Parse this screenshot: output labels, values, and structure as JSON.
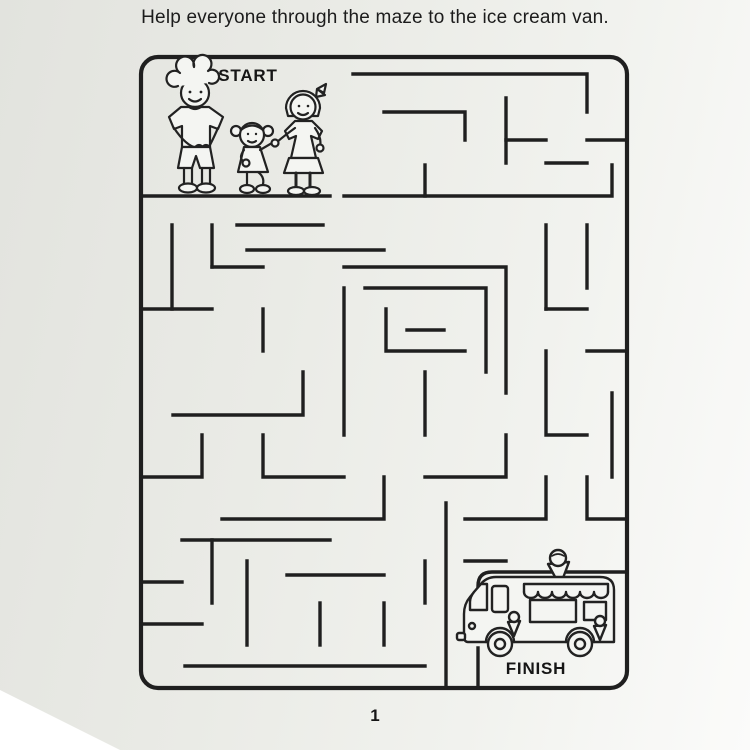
{
  "page": {
    "title": "Help everyone through the maze to the ice cream van.",
    "page_number": "1"
  },
  "colors": {
    "ink": "#1f1f1f",
    "paper_light": "#f1f2ee",
    "paper_dark": "#e2e3de"
  },
  "maze": {
    "start_label": "START",
    "finish_label": "FINISH",
    "finish_room_path": "M627,572 H492 Q478,572 478,586 V610 M478,648 V688",
    "walls": [
      [
        [
          141,
          196
        ],
        [
          330,
          196
        ]
      ],
      [
        [
          344,
          196
        ],
        [
          612,
          196
        ],
        [
          612,
          165
        ]
      ],
      [
        [
          425,
          196
        ],
        [
          425,
          165
        ]
      ],
      [
        [
          353,
          74
        ],
        [
          587,
          74
        ],
        [
          587,
          112
        ]
      ],
      [
        [
          384,
          112
        ],
        [
          465,
          112
        ],
        [
          465,
          140
        ]
      ],
      [
        [
          506,
          98
        ],
        [
          506,
          163
        ]
      ],
      [
        [
          506,
          140
        ],
        [
          546,
          140
        ]
      ],
      [
        [
          587,
          140
        ],
        [
          627,
          140
        ]
      ],
      [
        [
          546,
          163
        ],
        [
          587,
          163
        ]
      ],
      [
        [
          172,
          225
        ],
        [
          172,
          309
        ]
      ],
      [
        [
          212,
          225
        ],
        [
          212,
          267
        ]
      ],
      [
        [
          237,
          225
        ],
        [
          323,
          225
        ]
      ],
      [
        [
          212,
          267
        ],
        [
          263,
          267
        ]
      ],
      [
        [
          141,
          309
        ],
        [
          212,
          309
        ]
      ],
      [
        [
          247,
          250
        ],
        [
          384,
          250
        ]
      ],
      [
        [
          263,
          309
        ],
        [
          263,
          351
        ]
      ],
      [
        [
          344,
          267
        ],
        [
          506,
          267
        ],
        [
          506,
          393
        ]
      ],
      [
        [
          365,
          288
        ],
        [
          486,
          288
        ],
        [
          486,
          372
        ]
      ],
      [
        [
          386,
          309
        ],
        [
          386,
          351
        ],
        [
          465,
          351
        ]
      ],
      [
        [
          407,
          330
        ],
        [
          444,
          330
        ]
      ],
      [
        [
          344,
          288
        ],
        [
          344,
          435
        ]
      ],
      [
        [
          546,
          225
        ],
        [
          546,
          309
        ]
      ],
      [
        [
          587,
          225
        ],
        [
          587,
          288
        ]
      ],
      [
        [
          546,
          309
        ],
        [
          587,
          309
        ]
      ],
      [
        [
          587,
          351
        ],
        [
          627,
          351
        ]
      ],
      [
        [
          546,
          351
        ],
        [
          546,
          435
        ],
        [
          587,
          435
        ]
      ],
      [
        [
          173,
          415
        ],
        [
          303,
          415
        ],
        [
          303,
          372
        ]
      ],
      [
        [
          141,
          477
        ],
        [
          202,
          477
        ],
        [
          202,
          435
        ]
      ],
      [
        [
          263,
          435
        ],
        [
          263,
          477
        ],
        [
          344,
          477
        ]
      ],
      [
        [
          222,
          519
        ],
        [
          384,
          519
        ],
        [
          384,
          477
        ]
      ],
      [
        [
          425,
          372
        ],
        [
          425,
          435
        ]
      ],
      [
        [
          425,
          477
        ],
        [
          506,
          477
        ],
        [
          506,
          435
        ]
      ],
      [
        [
          546,
          477
        ],
        [
          546,
          519
        ],
        [
          465,
          519
        ]
      ],
      [
        [
          627,
          519
        ],
        [
          587,
          519
        ],
        [
          587,
          477
        ]
      ],
      [
        [
          612,
          393
        ],
        [
          612,
          477
        ]
      ],
      [
        [
          182,
          540
        ],
        [
          330,
          540
        ]
      ],
      [
        [
          212,
          540
        ],
        [
          212,
          603
        ]
      ],
      [
        [
          141,
          582
        ],
        [
          182,
          582
        ]
      ],
      [
        [
          247,
          561
        ],
        [
          247,
          645
        ]
      ],
      [
        [
          141,
          624
        ],
        [
          202,
          624
        ]
      ],
      [
        [
          287,
          575
        ],
        [
          384,
          575
        ]
      ],
      [
        [
          320,
          603
        ],
        [
          320,
          645
        ]
      ],
      [
        [
          384,
          603
        ],
        [
          384,
          645
        ]
      ],
      [
        [
          185,
          666
        ],
        [
          425,
          666
        ]
      ],
      [
        [
          425,
          561
        ],
        [
          425,
          603
        ]
      ],
      [
        [
          446,
          503
        ],
        [
          446,
          688
        ]
      ],
      [
        [
          465,
          561
        ],
        [
          506,
          561
        ]
      ]
    ]
  }
}
